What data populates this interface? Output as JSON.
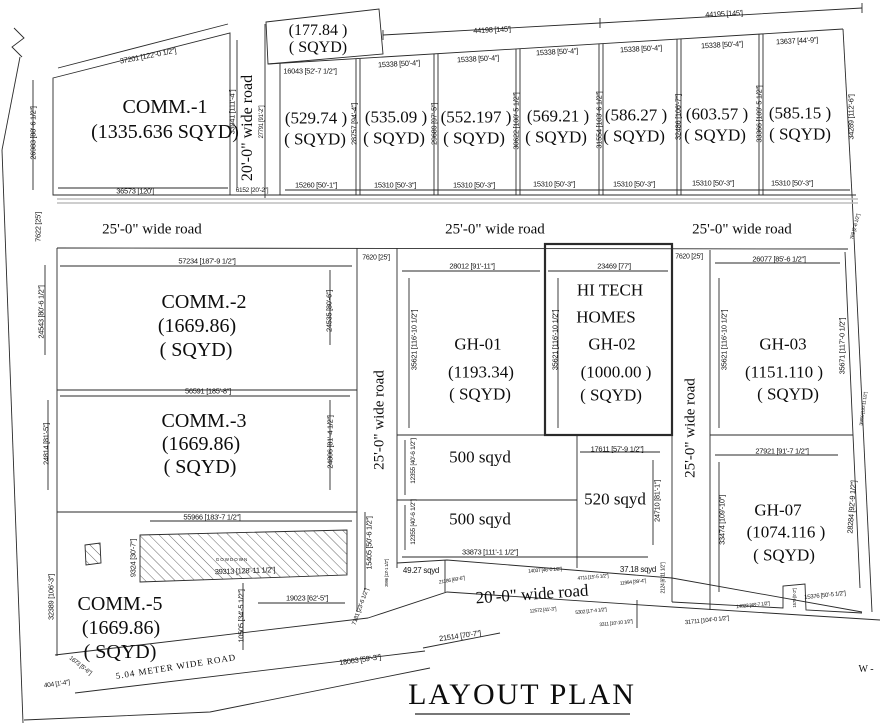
{
  "title": "LAYOUT PLAN",
  "compass_w": "W -",
  "plots": {
    "comm1": {
      "name": "COMM.-1",
      "area": "(1335.636 SQYD)"
    },
    "p177": {
      "area": "(177.84 )",
      "unit": "( SQYD)"
    },
    "shop1": {
      "area": "(529.74 )",
      "unit": "( SQYD)"
    },
    "shop2": {
      "area": "(535.09 )",
      "unit": "( SQYD)"
    },
    "shop3": {
      "area": "(552.197 )",
      "unit": "( SQYD)"
    },
    "shop4": {
      "area": "(569.21 )",
      "unit": "( SQYD)"
    },
    "shop5": {
      "area": "(586.27 )",
      "unit": "( SQYD)"
    },
    "shop6": {
      "area": "(603.57 )",
      "unit": "( SQYD)"
    },
    "shop7": {
      "area": "(585.15 )",
      "unit": "( SQYD)"
    },
    "comm2": {
      "name": "COMM.-2",
      "area": "(1669.86)",
      "unit": "( SQYD)"
    },
    "comm3": {
      "name": "COMM.-3",
      "area": "(1669.86)",
      "unit": "( SQYD)"
    },
    "comm5": {
      "name": "COMM.-5",
      "area": "(1669.86)",
      "unit": "( SQYD)"
    },
    "gh01": {
      "name": "GH-01",
      "area": "(1193.34)",
      "unit": "( SQYD)"
    },
    "gh02": {
      "owner1": "HI TECH",
      "owner2": "HOMES",
      "name": "GH-02",
      "area": "(1000.00 )",
      "unit": "( SQYD)"
    },
    "gh03": {
      "name": "GH-03",
      "area": "(1151.110 )",
      "unit": "( SQYD)"
    },
    "gh07": {
      "name": "GH-07",
      "area": "(1074.116 )",
      "unit": "( SQYD)"
    },
    "s500a": {
      "name": "500 sqyd"
    },
    "s500b": {
      "name": "500 sqyd"
    },
    "s520": {
      "name": "520 sqyd"
    },
    "s4927": {
      "name": "49.27 sqyd"
    },
    "s3718": {
      "name": "37.18 sqyd"
    },
    "godown": {
      "name": "GOWDOWN"
    }
  },
  "roads": {
    "r25a": "25'-0\" wide road",
    "r25b": "25'-0\" wide road",
    "r25c": "25'-0\" wide road",
    "r20top": "20'-0\" wide road",
    "r25v1": "25'-0\" wide road",
    "r25v2": "25'-0\" wide road",
    "r20bottom": "20'-0\" wide road",
    "meter": "5.04 METER WIDE ROAD"
  },
  "dims": {
    "d1": "37201 [122'-0 1/2\"]",
    "d2": "26983 [88'-6 1/2\"]",
    "d3": "33941 [111'-4\"]",
    "d4": "36573 [120']",
    "d5": "6152 [20'-2\"]",
    "d6": "27791 [91'-2\"]",
    "d7": "16043 [52'-7 1/2\"]",
    "d8": "15338 [50'-4\"]",
    "d9": "15338 [50'-4\"]",
    "d10": "15338 [50'-4\"]",
    "d11": "15338 [50'-4\"]",
    "d12": "15338 [50'-4\"]",
    "d13": "13637 [44'-9\"]",
    "d14": "44198 [145']",
    "d15": "44195 [145']",
    "d16": "15260 [50'-1\"]",
    "d17": "15310 [50'-3\"]",
    "d18": "15310 [50'-3\"]",
    "d19": "15310 [50'-3\"]",
    "d20": "15310 [50'-3\"]",
    "d21": "15310 [50'-3\"]",
    "d22": "15310 [50'-3\"]",
    "d23": "28757 [94'-4\"]",
    "d24": "29689 [97'-5\"]",
    "d25": "30622 [100'-5 1/2\"]",
    "d26": "31554 [103'-6 1/2\"]",
    "d27": "32486 [106'-7\"]",
    "d28": "33366 [109'-5 1/2\"]",
    "d29": "34289 [112'-6\"]",
    "d30": "7622 [25']",
    "d31": "57234 [187'-9 1/2\"]",
    "d32": "7620 [25']",
    "d33": "7620 [25']",
    "d34": "24543 [80'-6 1/2\"]",
    "d35": "24535 [80'-6\"]",
    "d36": "56591 [185'-8\"]",
    "d37": "24814 [81'-5\"]",
    "d38": "24806 [81'-4 1/2\"]",
    "d39": "55966 [183'-7 1/2\"]",
    "d40": "32389 [106'-3\"]",
    "d41": "39313 [128'-11 1/2\"]",
    "d42": "9324 [30'-7\"]",
    "d43": "15405 [50'-6 1/2\"]",
    "d44": "7181 [23'-6 1/2\"]",
    "d45": "3996 [13'-1 1/2\"]",
    "d46": "10505 [34'-5 1/2\"]",
    "d47": "19023 [62'-5\"]",
    "d48": "404 [1'-4\"]",
    "d49": "1673 [5'-6\"]",
    "d50": "18063 [59'-3\"]",
    "d51": "21514 [70'-7\"]",
    "d52": "28012 [91'-11\"]",
    "d53": "23469 [77']",
    "d54": "35621 [116'-10 1/2\"]",
    "d55": "35621 [116'-10 1/2\"]",
    "d56": "35621 [116'-10 1/2\"]",
    "d57": "26077 [85'-6 1/2\"]",
    "d58": "35671 [117'-0 1/2\"]",
    "d59": "27921 [91'-7 1/2\"]",
    "d60": "33474 [109'-10\"]",
    "d61": "28284 [92'-9 1/2\"]",
    "d62": "769 [2'-6 1/2\"]",
    "d63": "36850 [120'-11 1/2\"]",
    "d64": "12355 [40'-6 1/2\"]",
    "d65": "12355 [40'-6 1/2\"]",
    "d66": "17611 [57'-9 1/2\"]",
    "d67": "24710 [81'-1\"]",
    "d68": "33873 [111'-1 1/2\"]",
    "d69": "21186 [69'-6\"]",
    "d70": "14037 [46'-0 1/2\"]",
    "d71": "4711 [15'-5 1/2\"]",
    "d72": "11994 [39'-4\"]",
    "d73": "2124 [6'-11 1/2\"]",
    "d74": "12572 [41'-3\"]",
    "d75": "5302 [17'-4 1/2\"]",
    "d76": "3311 [10'-10 1/2\"]",
    "d77": "31711 [104'-0 1/2\"]",
    "d78": "14823 [48'-7 1/2\"]",
    "d79": "15376 [50'-5 1/2\"]",
    "d80": "1579 [5'-2\"]"
  }
}
